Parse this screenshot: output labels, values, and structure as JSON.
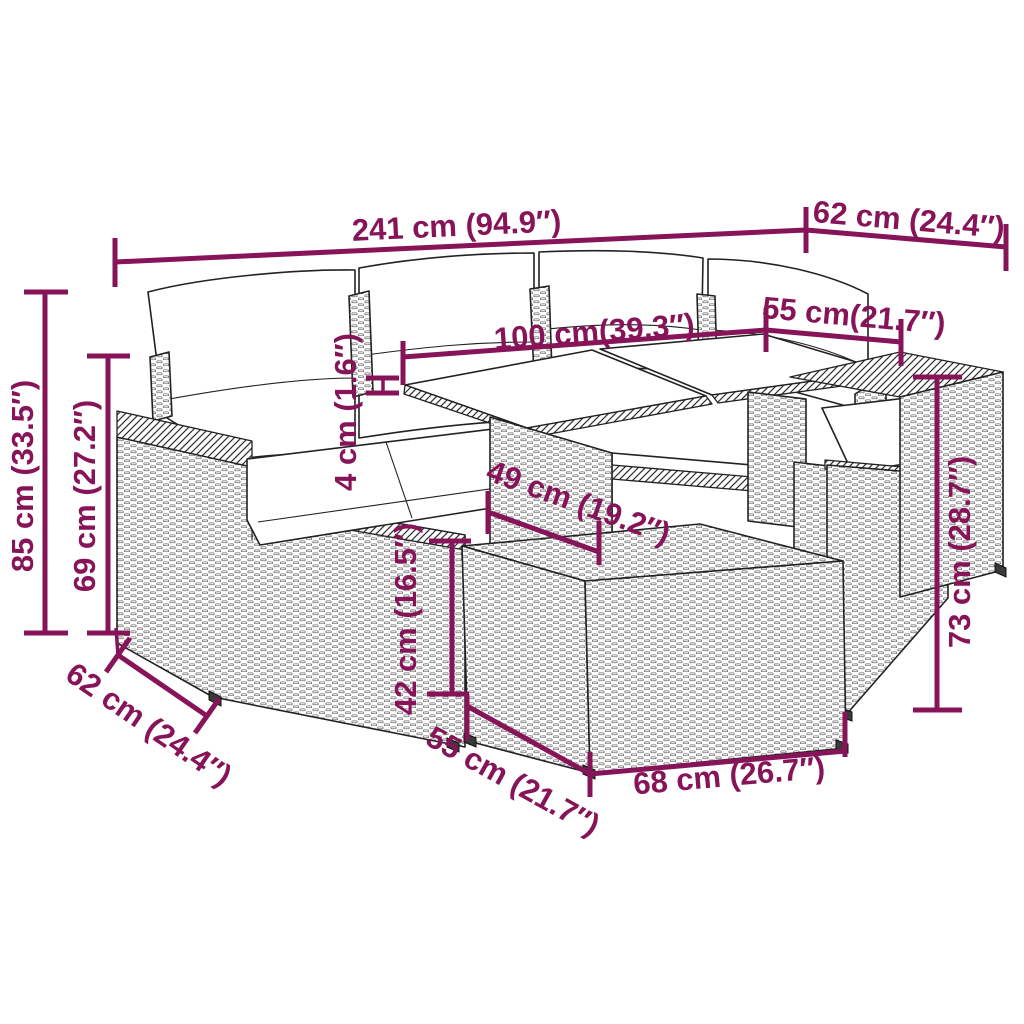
{
  "diagram": {
    "type": "product-dimension-diagram",
    "subject": "rattan-garden-lounge-set-with-table-and-stool",
    "accent_color": "#871458",
    "artwork_color": "#222222",
    "background_color": "#ffffff",
    "dims": {
      "total_length": "241 cm (94.9″)",
      "back_depth": "62 cm (24.4″)",
      "table_length": "100 cm(39.3″)",
      "table_width": "55 cm(21.7″)",
      "overall_height": "85 cm (33.5″)",
      "arm_height": "69 cm (27.2″)",
      "glass_thickness": "4 cm (1.6″)",
      "seat_depth": "49 cm (19.2″)",
      "stool_height": "42 cm (16.5″)",
      "side_depth": "62 cm (24.4″)",
      "stool_width": "55 cm (21.7″)",
      "stool_length": "68 cm (26.7″)",
      "table_height": "73 cm (28.7″)"
    }
  }
}
